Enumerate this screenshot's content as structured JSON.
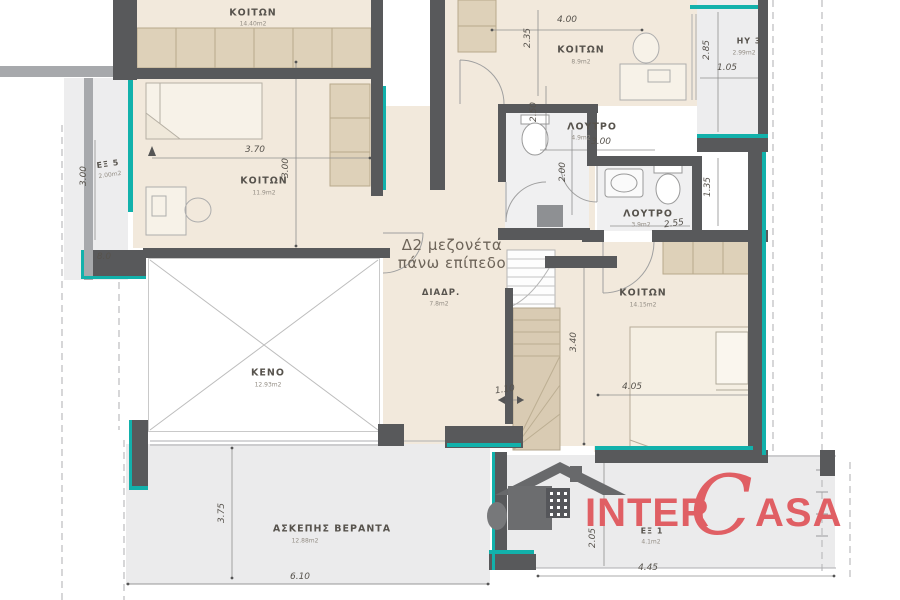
{
  "plan": {
    "title_line1": "Δ2 μεζονέτα",
    "title_line2": "πάνω επίπεδο",
    "rooms": {
      "bedroom_top_left": {
        "name": "ΚΟΙΤΩΝ",
        "area": "14.40m2"
      },
      "bedroom_left": {
        "name": "ΚΟΙΤΩΝ",
        "area": "11.9m2"
      },
      "bedroom_top_mid": {
        "name": "ΚΟΙΤΩΝ",
        "area": "8.9m2"
      },
      "bathroom_upper": {
        "name": "ΛΟΥΤΡΟ",
        "area": "4.9m2"
      },
      "bathroom_lower": {
        "name": "ΛΟΥΤΡΟ",
        "area": "3.9m2"
      },
      "bedroom_right": {
        "name": "ΚΟΙΤΩΝ",
        "area": "14.15m2"
      },
      "hall": {
        "name": "ΔΙΑΔΡ.",
        "area": "7.8m2"
      },
      "void": {
        "name": "ΚΕΝΟ",
        "area": "12.93m2"
      },
      "veranda": {
        "name": "ΑΣΚΕΠΗΣ ΒΕΡΑΝΤΑ",
        "area": "12.88m2"
      },
      "balcony_left": {
        "name": "ΕΞ 5",
        "area": "2.00m2"
      },
      "balcony_top_right": {
        "name": "ΗΥ 3",
        "area": "2.99m2"
      },
      "balcony_bottom": {
        "name": "ΕΞ 1",
        "area": "4.1m2"
      }
    },
    "dims": {
      "w400": "4.00",
      "h235": "2.35",
      "w370": "3.70",
      "h300_left": "3.00",
      "v250": "2.50",
      "w300_bath": "3.00",
      "h200": "2.00",
      "w105": "1.05",
      "h285": "2.85",
      "h135": "1.35",
      "w255": "2.55",
      "h340": "3.40",
      "w405": "4.05",
      "w110": "1.10",
      "h300_ex5": "3.00",
      "w80": "8.0",
      "h375": "3.75",
      "w610": "6.10",
      "h205": "2.05",
      "w445": "4.45"
    }
  },
  "logo": {
    "inter": "INTER",
    "c": "C",
    "asa": "ASA"
  },
  "colors": {
    "teal": "#12b1ab",
    "wall_dark": "#58595b",
    "room_fill": "#f2e9dc",
    "exterior_fill": "#ebedee",
    "logo_red": "#e05f64"
  }
}
